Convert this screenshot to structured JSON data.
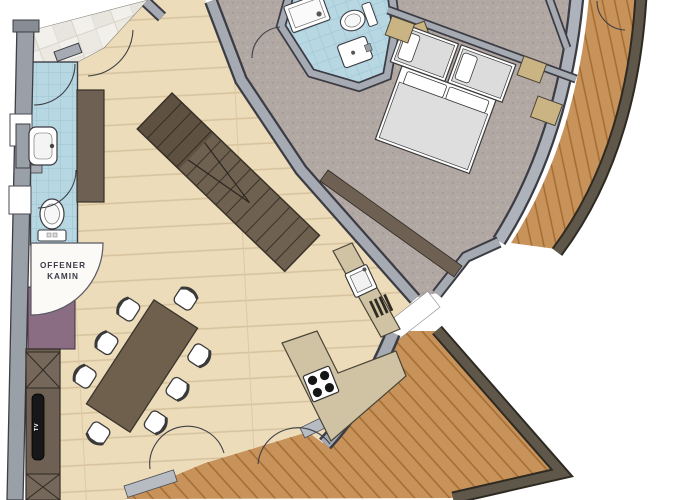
{
  "labels": {
    "fireplace_line1": "OFFENER",
    "fireplace_line2": "KAMIN",
    "tv": "TV"
  },
  "palette": {
    "background": "#ffffff",
    "wall_gray": "#a6abb3",
    "wall_outline": "#3c3c44",
    "wood_floor": "#ecdcba",
    "wood_line": "#d6c29c",
    "deck_wood": "#c8935a",
    "deck_line": "#a26b31",
    "deck_rim": "#5f584a",
    "carpet": "#b2a8a3",
    "tile_blue": "#b7d7e2",
    "tile_entry": "#f2f0ea",
    "counter_tan": "#cfc3a3",
    "stair_brown": "#6f6150",
    "furniture_brown": "#6e6052",
    "table_brown": "#6f604d",
    "accent_purple": "#8b6d83",
    "label_text": "#3b3b48",
    "fixture_white": "#ffffff"
  }
}
